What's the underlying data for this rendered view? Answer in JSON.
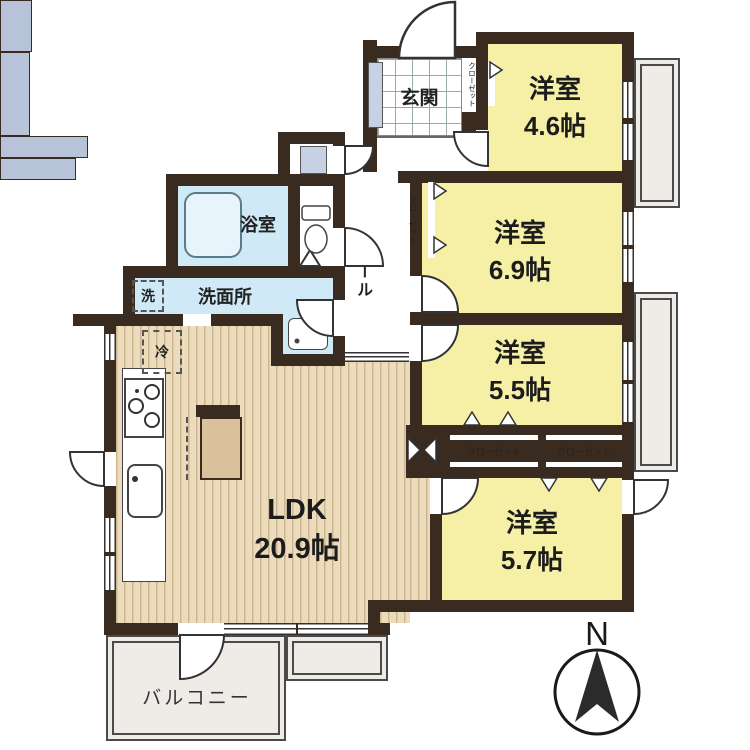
{
  "plan": {
    "title": "apartment-floorplan",
    "rooms": [
      {
        "name": "洋室",
        "size": "4.6帖"
      },
      {
        "name": "洋室",
        "size": "6.9帖"
      },
      {
        "name": "洋室",
        "size": "5.5帖"
      },
      {
        "name": "洋室",
        "size": "5.7帖"
      }
    ],
    "ldk": {
      "name": "LDK",
      "size": "20.9帖"
    },
    "bath": "浴室",
    "washroom": "洗面所",
    "washer": "洗",
    "fridge": "冷",
    "entrance": "玄関",
    "hall": "ホール",
    "closet": "クローゼット",
    "balcony": "バルコニー",
    "compass_north": "N",
    "colors": {
      "wall": "#3a2b20",
      "western_room": "#f5f0a6",
      "wood_floor": "#eddcbb",
      "water_area": "#cfe9f6",
      "closet": "#b6c3d8",
      "balcony": "#efece7"
    }
  }
}
